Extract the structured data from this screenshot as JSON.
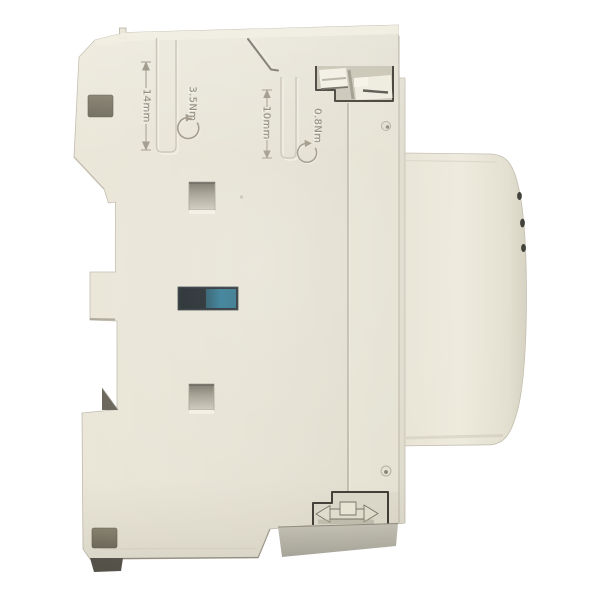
{
  "scene": {
    "type": "product-photo",
    "subject": "Side view of a beige DIN-rail mounted modular contactor",
    "background_color": "#ffffff"
  },
  "device": {
    "body_color": "#e6e2d3",
    "top_face_color": "#f1eee1",
    "front_cover_color": "#ebe7d9",
    "base_shadow_color": "#b2afa2",
    "foot_color": "#545148",
    "recess_hole_color": "#76715f",
    "emboss_color": "#8e8977",
    "indicator": {
      "window_dark": "#0d161b",
      "window_teal": "#1d6d89"
    },
    "markings": {
      "rail_width": "14mm",
      "top_torque": "3.5Nm",
      "terminal_width": "10mm",
      "terminal_torque": "0.8Nm"
    }
  }
}
